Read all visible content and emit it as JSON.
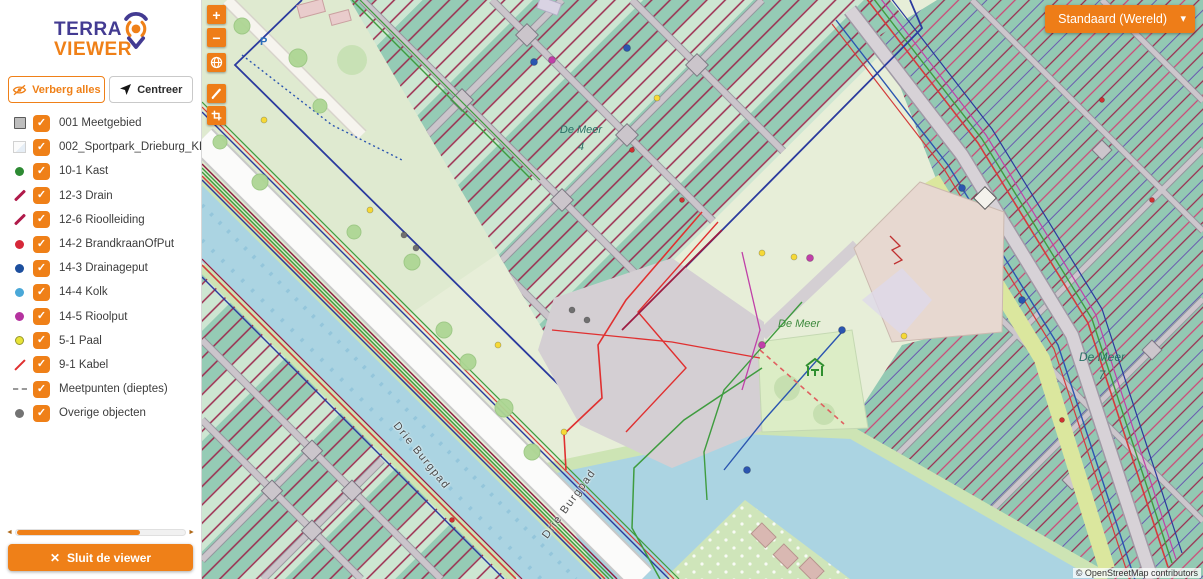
{
  "app": {
    "name_line1": "TERRA",
    "name_line2": "VIEWER"
  },
  "icons": {
    "check": "✓",
    "chevron_down": "▾",
    "close": "✕",
    "zoom_in": "+",
    "zoom_out": "−",
    "scroll_left": "◄",
    "scroll_right": "►"
  },
  "sidebar": {
    "hide_all_button": "Verberg alles",
    "center_button": "Centreer",
    "close_button": "Sluit de viewer",
    "layers": [
      {
        "label": "001 Meetgebied",
        "swatch": "square",
        "color": "#bdbdbd",
        "checked": true
      },
      {
        "label": "002_Sportpark_Drieburg_KLIC_25",
        "swatch": "image",
        "color": "#e6eef6",
        "checked": true
      },
      {
        "label": "10-1 Kast",
        "swatch": "dot",
        "color": "#2d8a33",
        "checked": true
      },
      {
        "label": "12-3 Drain",
        "swatch": "line",
        "color": "#b01a4a",
        "checked": true
      },
      {
        "label": "12-6 Rioolleiding",
        "swatch": "line",
        "color": "#b01a4a",
        "checked": true
      },
      {
        "label": "14-2 BrandkraanOfPut",
        "swatch": "dot",
        "color": "#d62839",
        "checked": true
      },
      {
        "label": "14-3 Drainageput",
        "swatch": "dot",
        "color": "#1d4f9e",
        "checked": true
      },
      {
        "label": "14-4 Kolk",
        "swatch": "dot",
        "color": "#4aa8d8",
        "checked": true
      },
      {
        "label": "14-5 Rioolput",
        "swatch": "dot",
        "color": "#b5339f",
        "checked": true
      },
      {
        "label": "5-1 Paal",
        "swatch": "dot-ring",
        "color": "#e8e337",
        "checked": true
      },
      {
        "label": "9-1 Kabel",
        "swatch": "thinline",
        "color": "#e03030",
        "checked": true
      },
      {
        "label": "Meetpunten (dieptes)",
        "swatch": "dashline",
        "color": "#9a9a9a",
        "checked": true
      },
      {
        "label": "Overige objecten",
        "swatch": "dot",
        "color": "#737373",
        "checked": true
      }
    ]
  },
  "map": {
    "basemap_selector": "Standaard (Wereld)",
    "attribution": "© OpenStreetMap contributors",
    "parking_label": "P",
    "controls": [
      "zoom-in",
      "zoom-out",
      "locate",
      "draw",
      "select-area"
    ],
    "labels": {
      "de_meer_a": {
        "name": "De Meer",
        "number": "4"
      },
      "de_meer_b": {
        "name": "De Meer"
      },
      "de_meer_c": {
        "name": "De Meer",
        "number": "7"
      },
      "burgpad_a": "Drie Burgpad",
      "burgpad_b": "Drie Burgpad"
    }
  },
  "colors": {
    "accent_orange": "#ef8018",
    "brand_purple": "#433b92",
    "allotment_teal": "#95cbb5",
    "hatch_red": "#9c2a4e",
    "water_blue": "#abd4e2"
  }
}
